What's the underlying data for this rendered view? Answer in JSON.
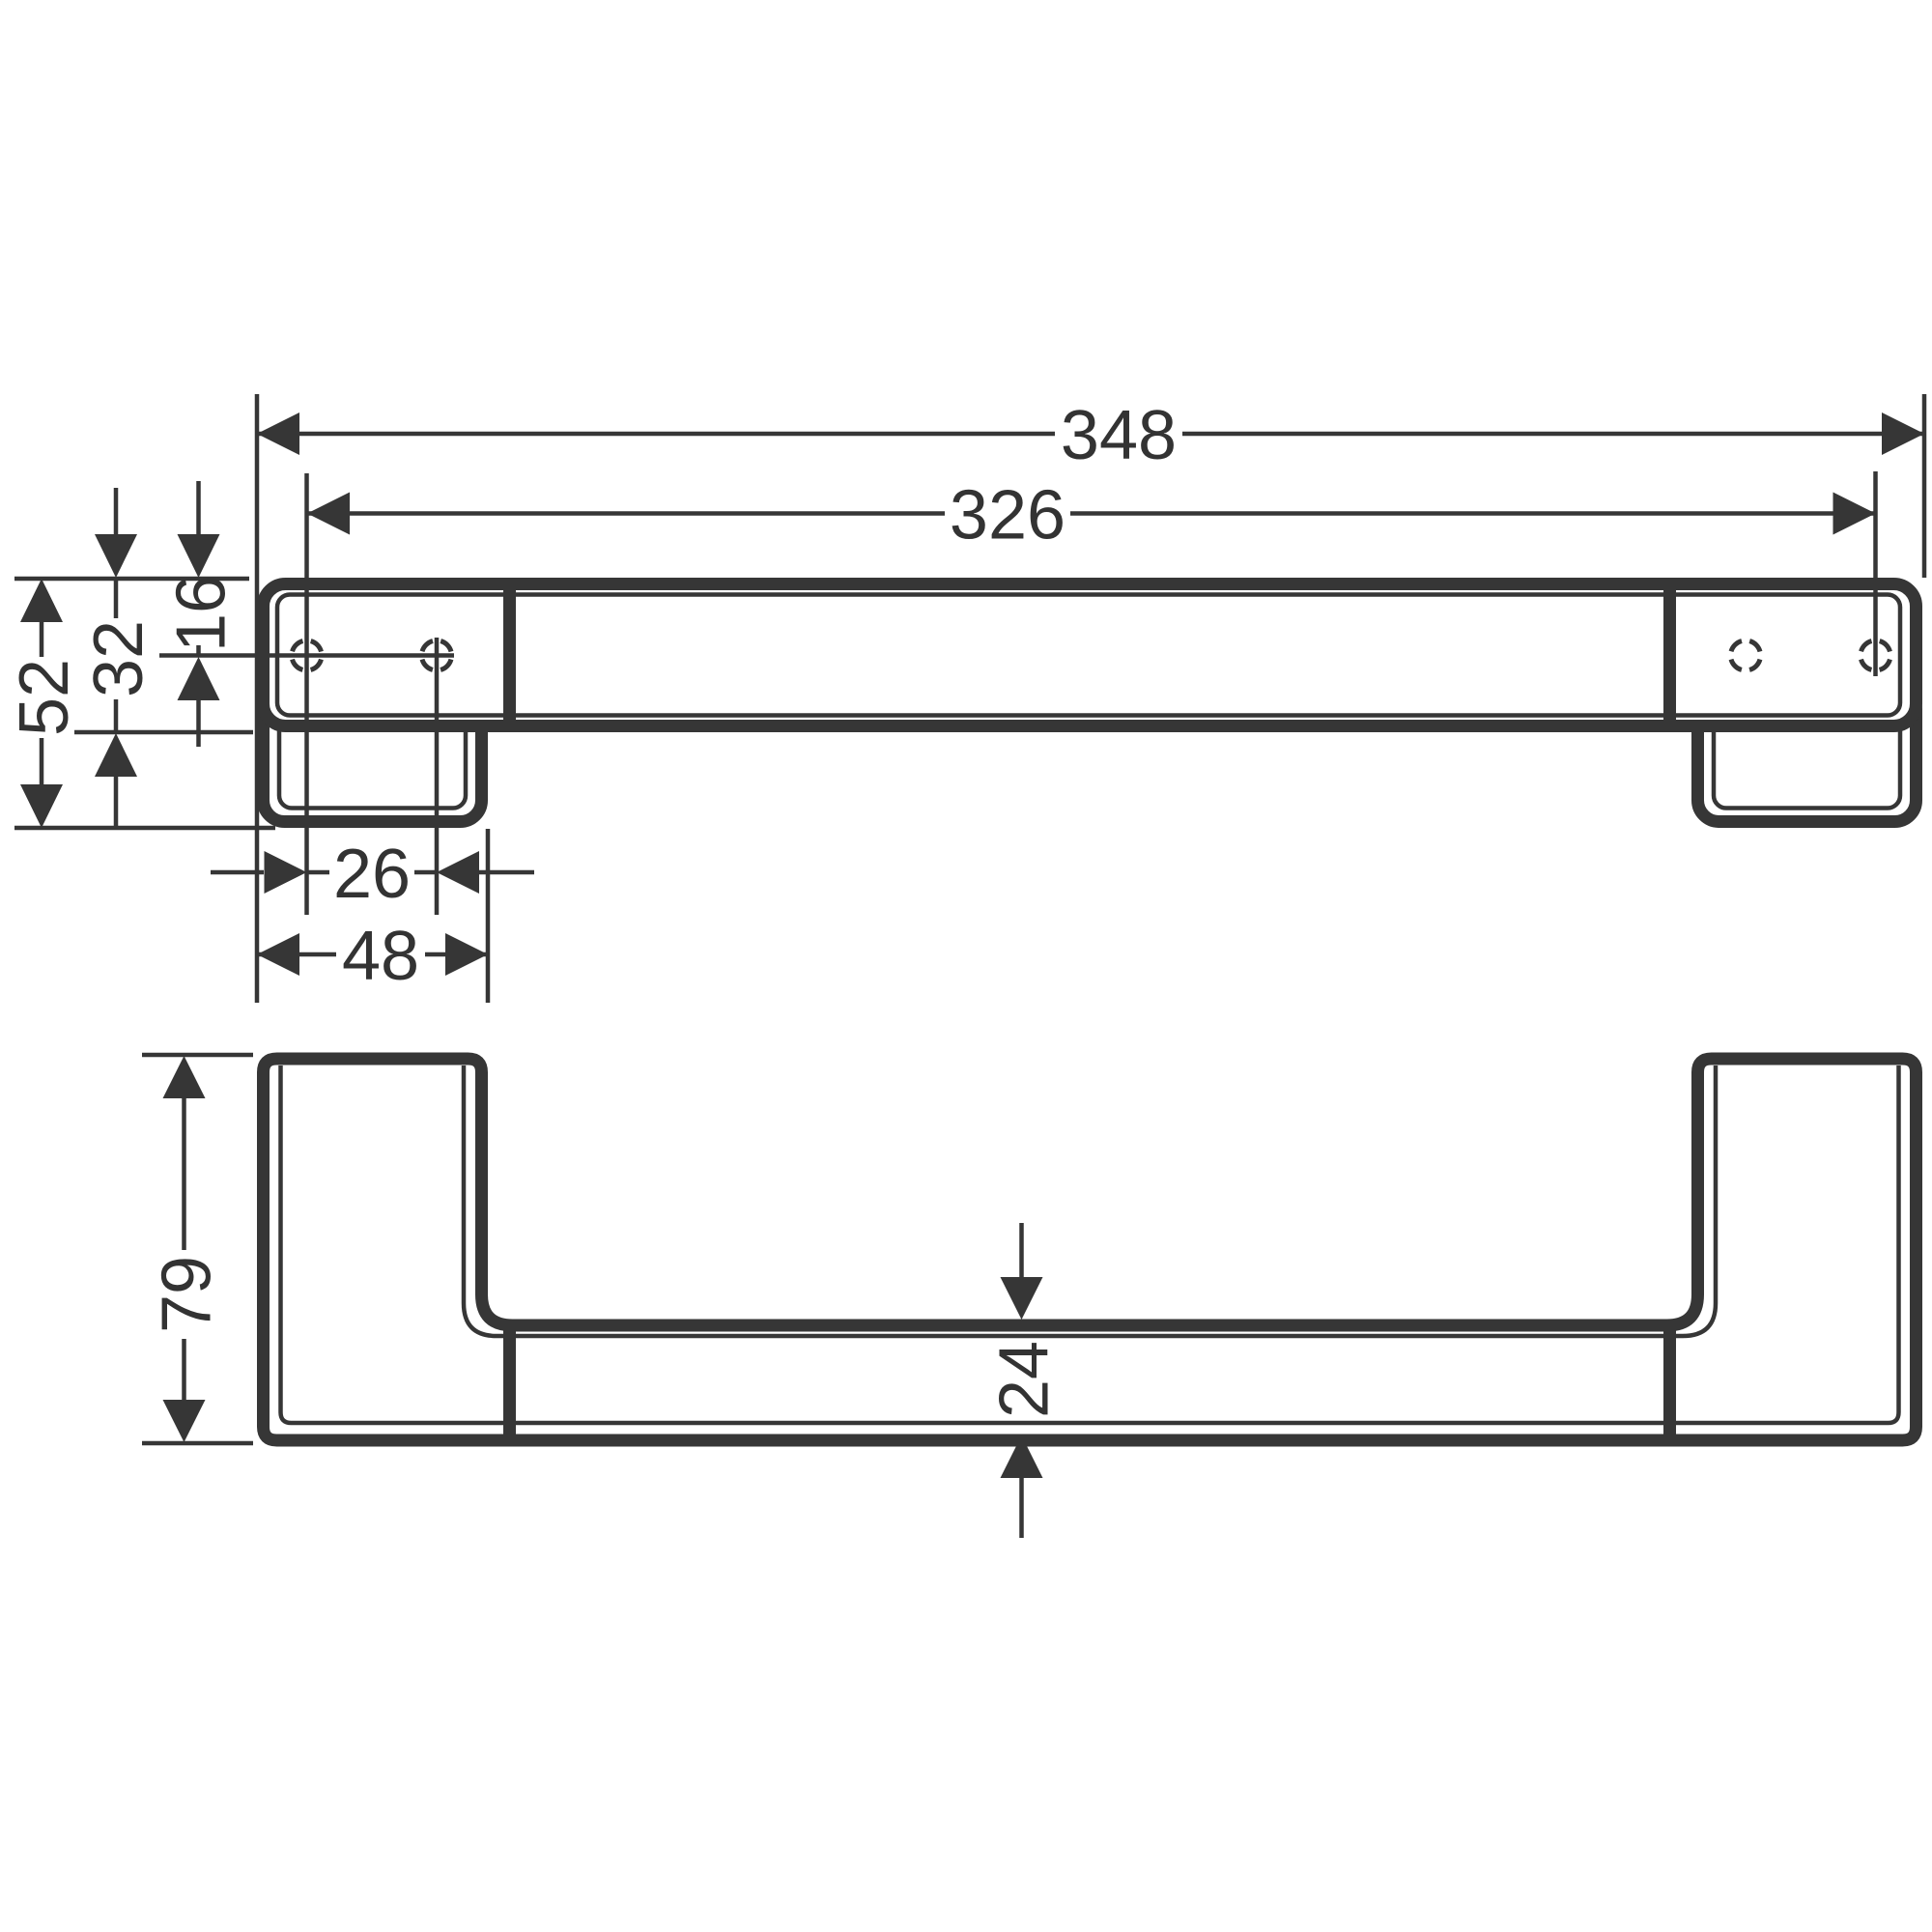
{
  "title": "Technical dimension drawing - wall grab bar, two orthographic views",
  "colors": {
    "background": "#ffffff",
    "line": "#363636",
    "text": "#333333"
  },
  "views": {
    "top": {
      "dims": {
        "overall_length": "348",
        "hole_span": "326",
        "end_depth": "52",
        "bar_depth": "32",
        "hole_offset": "16",
        "hole_pitch": "26",
        "bracket_width": "48"
      }
    },
    "front": {
      "dims": {
        "overall_height": "79",
        "bar_thickness": "24"
      }
    }
  }
}
